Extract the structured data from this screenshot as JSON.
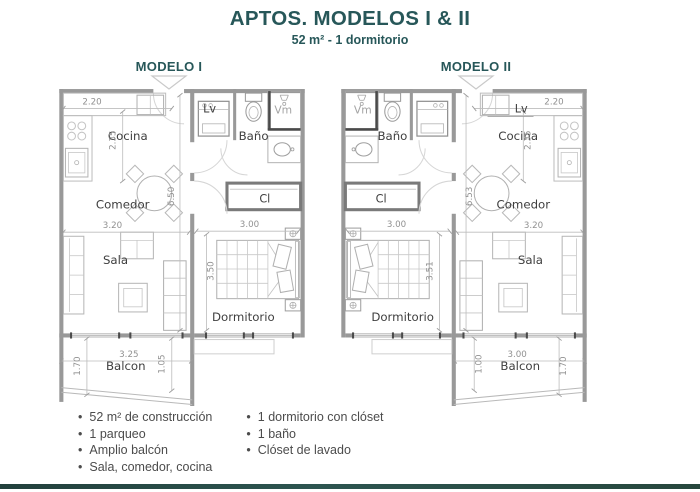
{
  "header": {
    "title": "APTOS. MODELOS I & II",
    "subtitle": "52 m² - 1 dormitorio"
  },
  "plans": [
    {
      "model_label": "MODELO I",
      "mirror": false,
      "rooms": {
        "cocina": "Cocina",
        "comedor": "Comedor",
        "sala": "Sala",
        "balcon": "Balcon",
        "dormitorio": "Dormitorio",
        "bano": "Baño",
        "lavadora": "Lv",
        "vm": "Vm",
        "closet": "Cl"
      },
      "dims": {
        "kitchen_width": "2.20",
        "kitchen_depth": "2.35",
        "comedor_width": "3.20",
        "unit_depth": "6.50",
        "dorm_width": "3.00",
        "dorm_depth": "3.50",
        "balcony_width": "3.25",
        "balcony_side": "1.70",
        "balcony_inner": "1.05"
      }
    },
    {
      "model_label": "MODELO II",
      "mirror": true,
      "rooms": {
        "cocina": "Cocina",
        "comedor": "Comedor",
        "sala": "Sala",
        "balcon": "Balcon",
        "dormitorio": "Dormitorio",
        "bano": "Baño",
        "lavadora": "Lv",
        "vm": "Vm",
        "closet": "Cl"
      },
      "dims": {
        "kitchen_width": "2.20",
        "kitchen_depth": "2.35",
        "comedor_width": "3.20",
        "unit_depth": "6.53",
        "dorm_width": "3.00",
        "dorm_depth": "3.51",
        "balcony_width": "3.00",
        "balcony_side": "1.70",
        "balcony_inner": "1.00"
      }
    }
  ],
  "features": {
    "column_left": [
      "52 m² de construcción",
      "1 parqueo",
      "Amplio balcón",
      "Sala, comedor, cocina"
    ],
    "column_right": [
      "1 dormitorio con clóset",
      "1 baño",
      "Clóset de lavado"
    ]
  },
  "colors": {
    "accent": "#275759",
    "wall": "#999999",
    "label": "#3e3e3e",
    "dim": "#919191",
    "furniture": "#b6b6b6",
    "footer_left": "#22403c",
    "footer_right": "#2d5550"
  }
}
